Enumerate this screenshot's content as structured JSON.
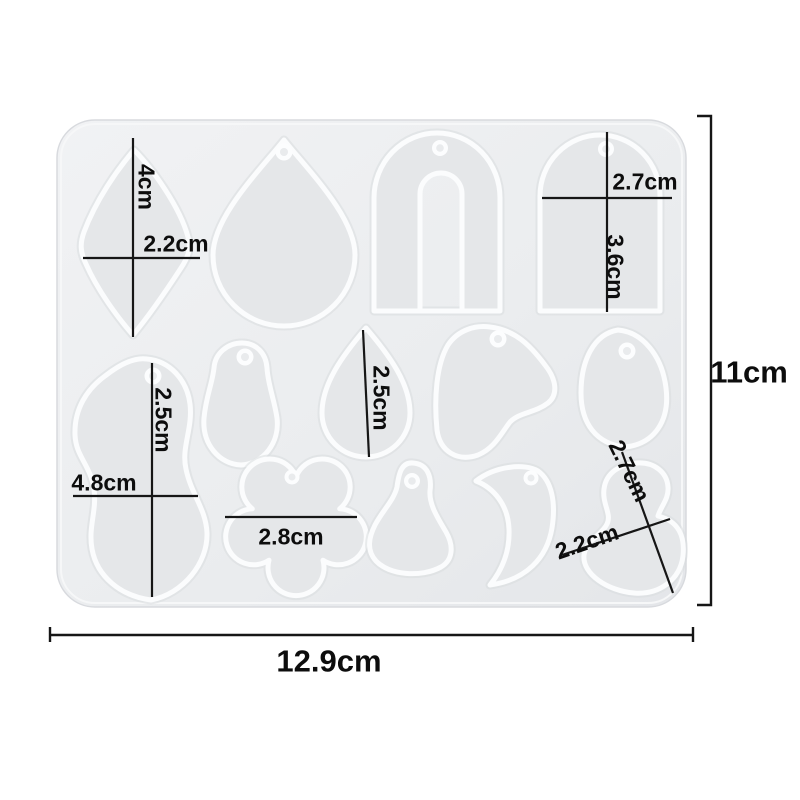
{
  "product": {
    "description": "silicone-earring-pendant-resin-mold-with-13-cavities",
    "overall": {
      "width": "12.9cm",
      "height": "11cm"
    },
    "cavities": {
      "leaf": {
        "height": "4cm",
        "width": "2.2cm"
      },
      "arched_tag": {
        "width": "2.7cm",
        "height": "3.6cm"
      },
      "teardrop_medium": {
        "length": "2.5cm"
      },
      "wavy_blob": {
        "height": "2.5cm",
        "width": "4.8cm"
      },
      "flower": {
        "width": "2.8cm"
      },
      "axe_blob": {
        "width": "2.2cm",
        "length": "2.7cm"
      }
    }
  },
  "colors": {
    "background": "#ffffff",
    "mold_body": "#eceef0",
    "cavity_fill": "#e5e7e9",
    "cavity_rim": "#fbfcfd",
    "dimension_ink": "#161616"
  }
}
